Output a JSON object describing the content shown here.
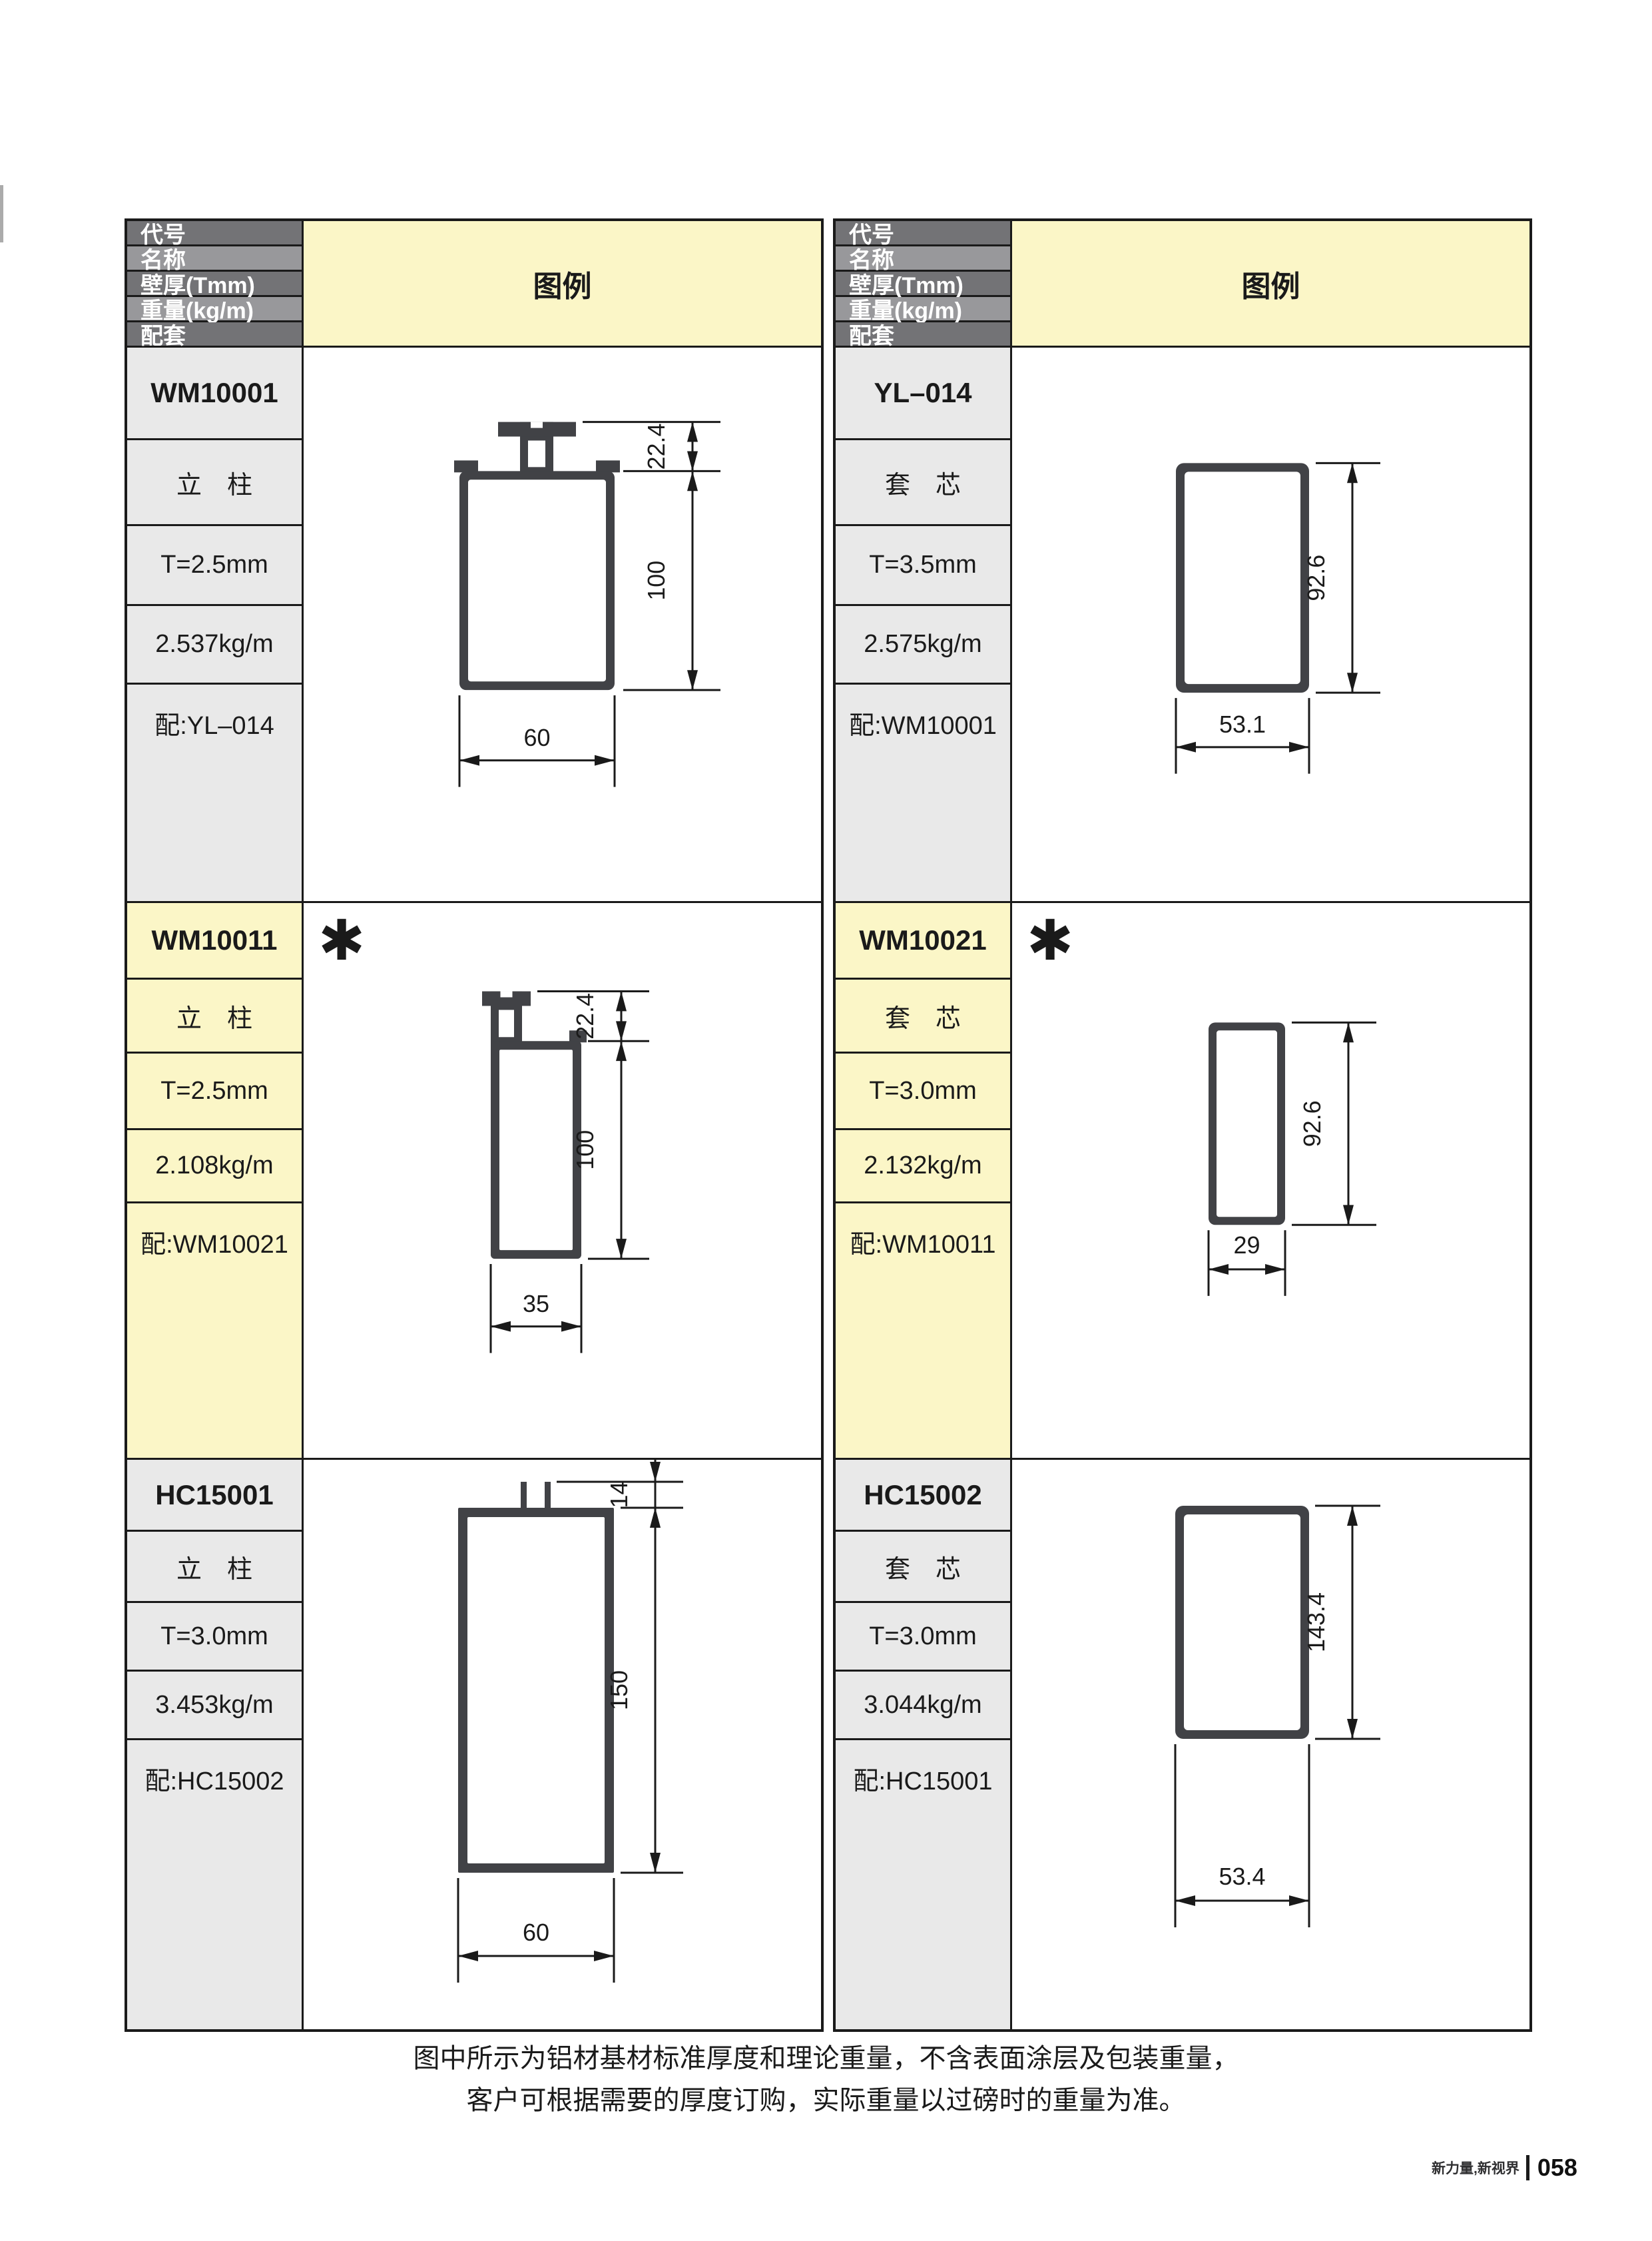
{
  "page": {
    "legend_label": "图例",
    "header_labels": [
      "代号",
      "名称",
      "壁厚(Tmm)",
      "重量(kg/m)",
      "配套"
    ],
    "asterisk_glyph": "✱",
    "note_line1": "图中所示为铝材基材标准厚度和理论重量，不含表面涂层及包装重量，",
    "note_line2": "客户可根据需要的厚度订购，实际重量以过磅时的重量为准。",
    "footer_brand": "新力量,新视界",
    "footer_page": "058"
  },
  "colors": {
    "accent_yellow": "#FBF6C7",
    "cell_gray": "#E9E9E9",
    "header_dark": "#737376",
    "header_light": "#98989B",
    "line": "#1A1A1A",
    "profile_fill": "#414246"
  },
  "profiles": [
    {
      "code": "WM10001",
      "name": "立　柱",
      "thickness": "T=2.5mm",
      "weight": "2.537kg/m",
      "match": "配:YL–014",
      "highlight": false,
      "asterisk": false,
      "drawing": {
        "shape": "tee-top-tube",
        "width_label": "60",
        "height_label": "100",
        "top_label": "22.4"
      }
    },
    {
      "code": "YL–014",
      "name": "套　芯",
      "thickness": "T=3.5mm",
      "weight": "2.575kg/m",
      "match": "配:WM10001",
      "highlight": false,
      "asterisk": false,
      "drawing": {
        "shape": "tube",
        "width_label": "53.1",
        "height_label": "92.6"
      }
    },
    {
      "code": "WM10011",
      "name": "立　柱",
      "thickness": "T=2.5mm",
      "weight": "2.108kg/m",
      "match": "配:WM10021",
      "highlight": true,
      "asterisk": true,
      "drawing": {
        "shape": "tab-left-tube",
        "width_label": "35",
        "height_label": "100",
        "top_label": "22.4"
      }
    },
    {
      "code": "WM10021",
      "name": "套　芯",
      "thickness": "T=3.0mm",
      "weight": "2.132kg/m",
      "match": "配:WM10011",
      "highlight": true,
      "asterisk": true,
      "drawing": {
        "shape": "tube",
        "width_label": "29",
        "height_label": "92.6"
      }
    },
    {
      "code": "HC15001",
      "name": "立　柱",
      "thickness": "T=3.0mm",
      "weight": "3.453kg/m",
      "match": "配:HC15002",
      "highlight": false,
      "asterisk": false,
      "drawing": {
        "shape": "prongs-top-tube",
        "width_label": "60",
        "height_label": "150",
        "top_label": "14"
      }
    },
    {
      "code": "HC15002",
      "name": "套　芯",
      "thickness": "T=3.0mm",
      "weight": "3.044kg/m",
      "match": "配:HC15001",
      "highlight": false,
      "asterisk": false,
      "drawing": {
        "shape": "tube",
        "width_label": "53.4",
        "height_label": "143.4"
      }
    }
  ]
}
